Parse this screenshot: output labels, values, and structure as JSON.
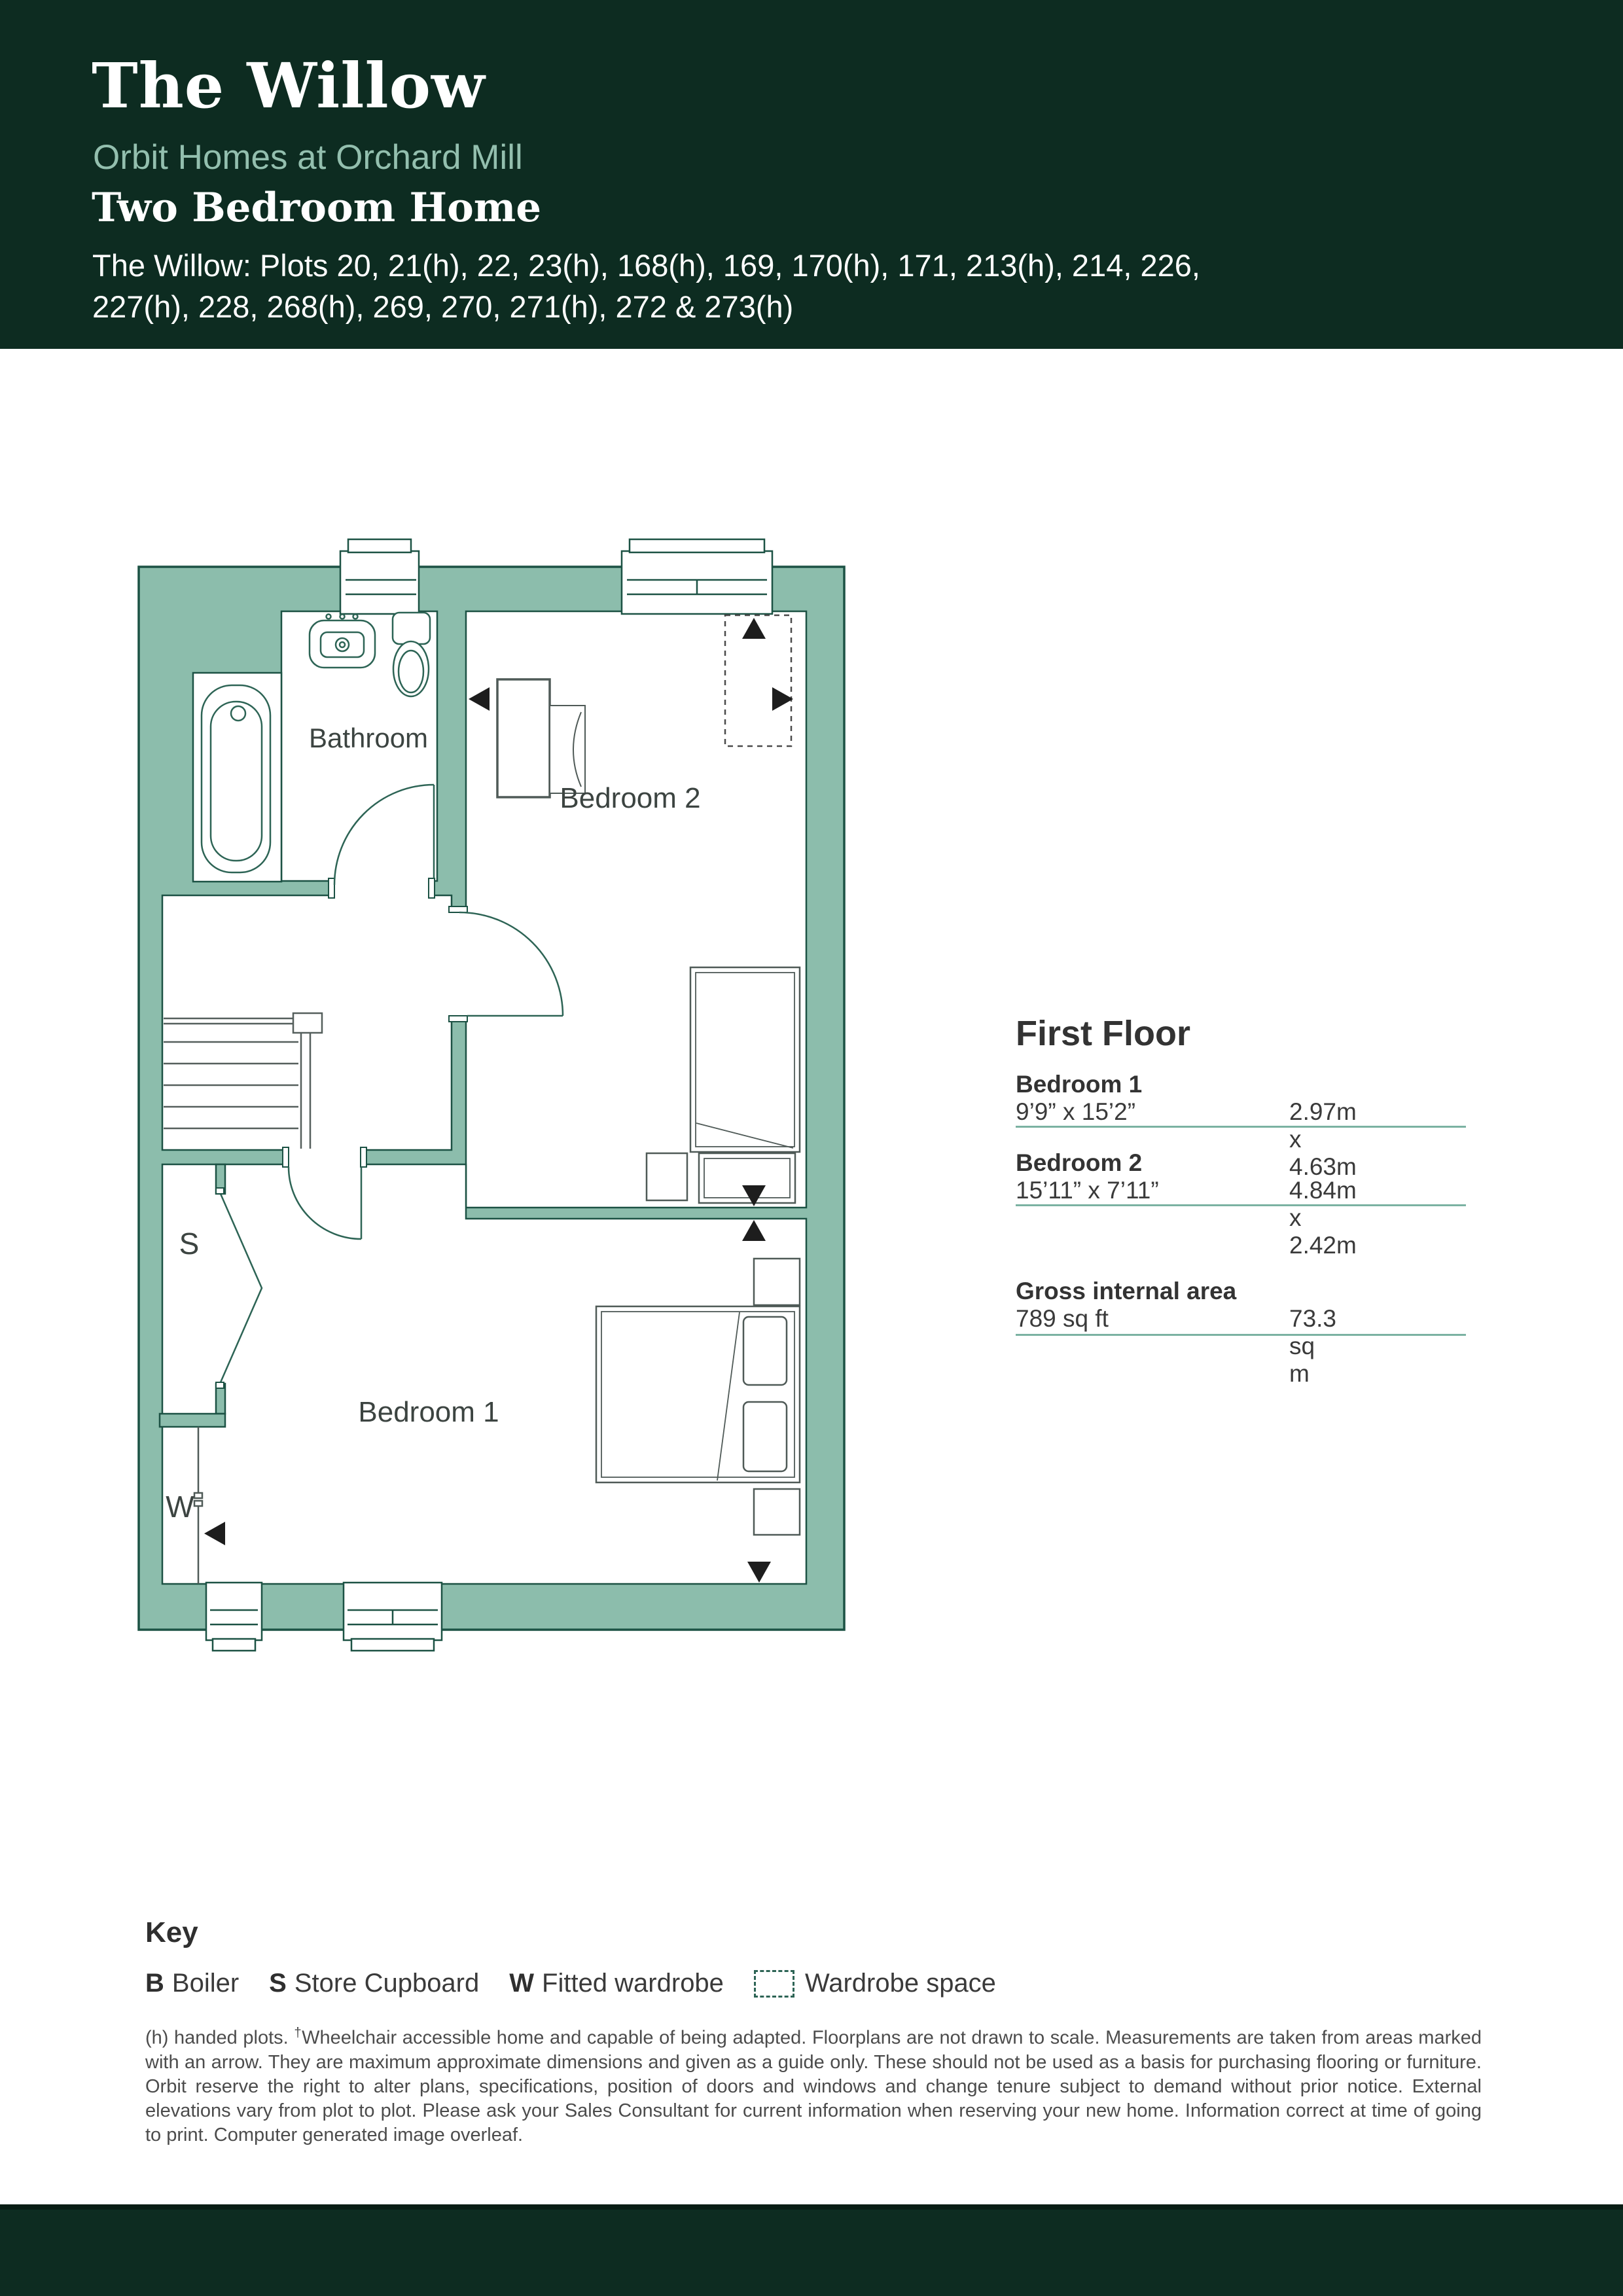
{
  "colors": {
    "header_bg": "#0d2c21",
    "accent_sage": "#93bfae",
    "wall_fill": "#8cbdac",
    "wall_stroke": "#1c5244",
    "fixture_stroke": "#2d6455",
    "rule": "#7bb2a2"
  },
  "header": {
    "title": "The Willow",
    "subtitle": "Orbit Homes at Orchard Mill",
    "home_type": "Two Bedroom Home",
    "plots_line1": "The Willow: Plots 20, 21(h), 22, 23(h), 168(h), 169, 170(h), 171, 213(h), 214, 226,",
    "plots_line2": "227(h), 228, 268(h), 269, 270, 271(h), 272 & 273(h)"
  },
  "floorplan": {
    "labels": {
      "bathroom": "Bathroom",
      "bedroom2": "Bedroom 2",
      "bedroom1": "Bedroom 1",
      "store": "S",
      "wardrobe": "W"
    }
  },
  "panel": {
    "heading": "First Floor",
    "rooms": [
      {
        "name": "Bedroom 1",
        "imperial": "9’9” x 15’2”",
        "metric": "2.97m x 4.63m"
      },
      {
        "name": "Bedroom 2",
        "imperial": "15’11” x 7’11”",
        "metric": "4.84m x 2.42m"
      }
    ],
    "gross": {
      "label": "Gross internal area",
      "imperial": "789 sq ft",
      "metric": "73.3 sq m"
    }
  },
  "key": {
    "heading": "Key",
    "items": [
      {
        "symbol": "B",
        "label": "Boiler"
      },
      {
        "symbol": "S",
        "label": "Store Cupboard"
      },
      {
        "symbol": "W",
        "label": "Fitted wardrobe"
      },
      {
        "symbol": "",
        "label": "Wardrobe space"
      }
    ]
  },
  "disclaimer": {
    "part1": "(h) handed plots. ",
    "dagger": "†",
    "part2": "Wheelchair accessible home and capable of being adapted. Floorplans are not drawn to scale. Measurements are taken from areas marked with an arrow. They are maximum approximate dimensions and given as a guide only. These should not be used as a basis for purchasing flooring or furniture. Orbit reserve the right to alter plans, specifications, position of doors and windows and change tenure subject to demand without prior notice. External elevations vary from plot to plot. Please ask your Sales Consultant for current information when reserving your new home. Information correct at time of going to print. Computer generated image overleaf."
  }
}
